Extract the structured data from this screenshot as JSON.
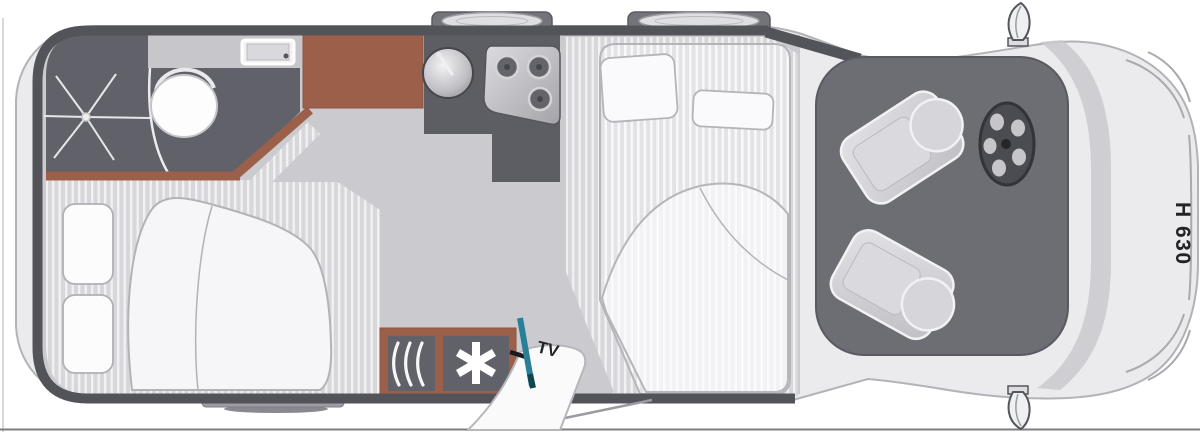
{
  "diagram": {
    "type": "motorhome-floorplan-top-view",
    "labels": {
      "height_badge": "H 630",
      "tv_label": "TV"
    },
    "colors": {
      "body": "#ebebed",
      "body_edge": "#b2b2b7",
      "floor": "#cbcbcf",
      "stripe_base": "#d7d7db",
      "stripe_lite": "#f1f1f3",
      "mattress_base": "#e3e3e7",
      "mattress_lite": "#f8f8fa",
      "wall": "#53535a",
      "room": "#61616a",
      "room2": "#5d5d64",
      "wood": "#9c604a",
      "cab": "#6d6d74",
      "seat": "#cfcfd4",
      "seat_hilite": "#f2f2f4",
      "white_item": "#fbfbfc",
      "teal": "#2a7f98",
      "text": "#222326"
    },
    "features": [
      "shower",
      "toilet",
      "washbasin",
      "bathroom-counter",
      "wardrobe",
      "kitchen-sink",
      "hob-3-burner",
      "rear-bed",
      "drop-down-bed",
      "heater",
      "fridge",
      "tv-mount",
      "entry-door",
      "entry-step",
      "driver-seat",
      "passenger-seat",
      "steering-wheel",
      "roof-vent-1",
      "roof-vent-2",
      "side-mirror-top",
      "side-mirror-bottom"
    ]
  }
}
